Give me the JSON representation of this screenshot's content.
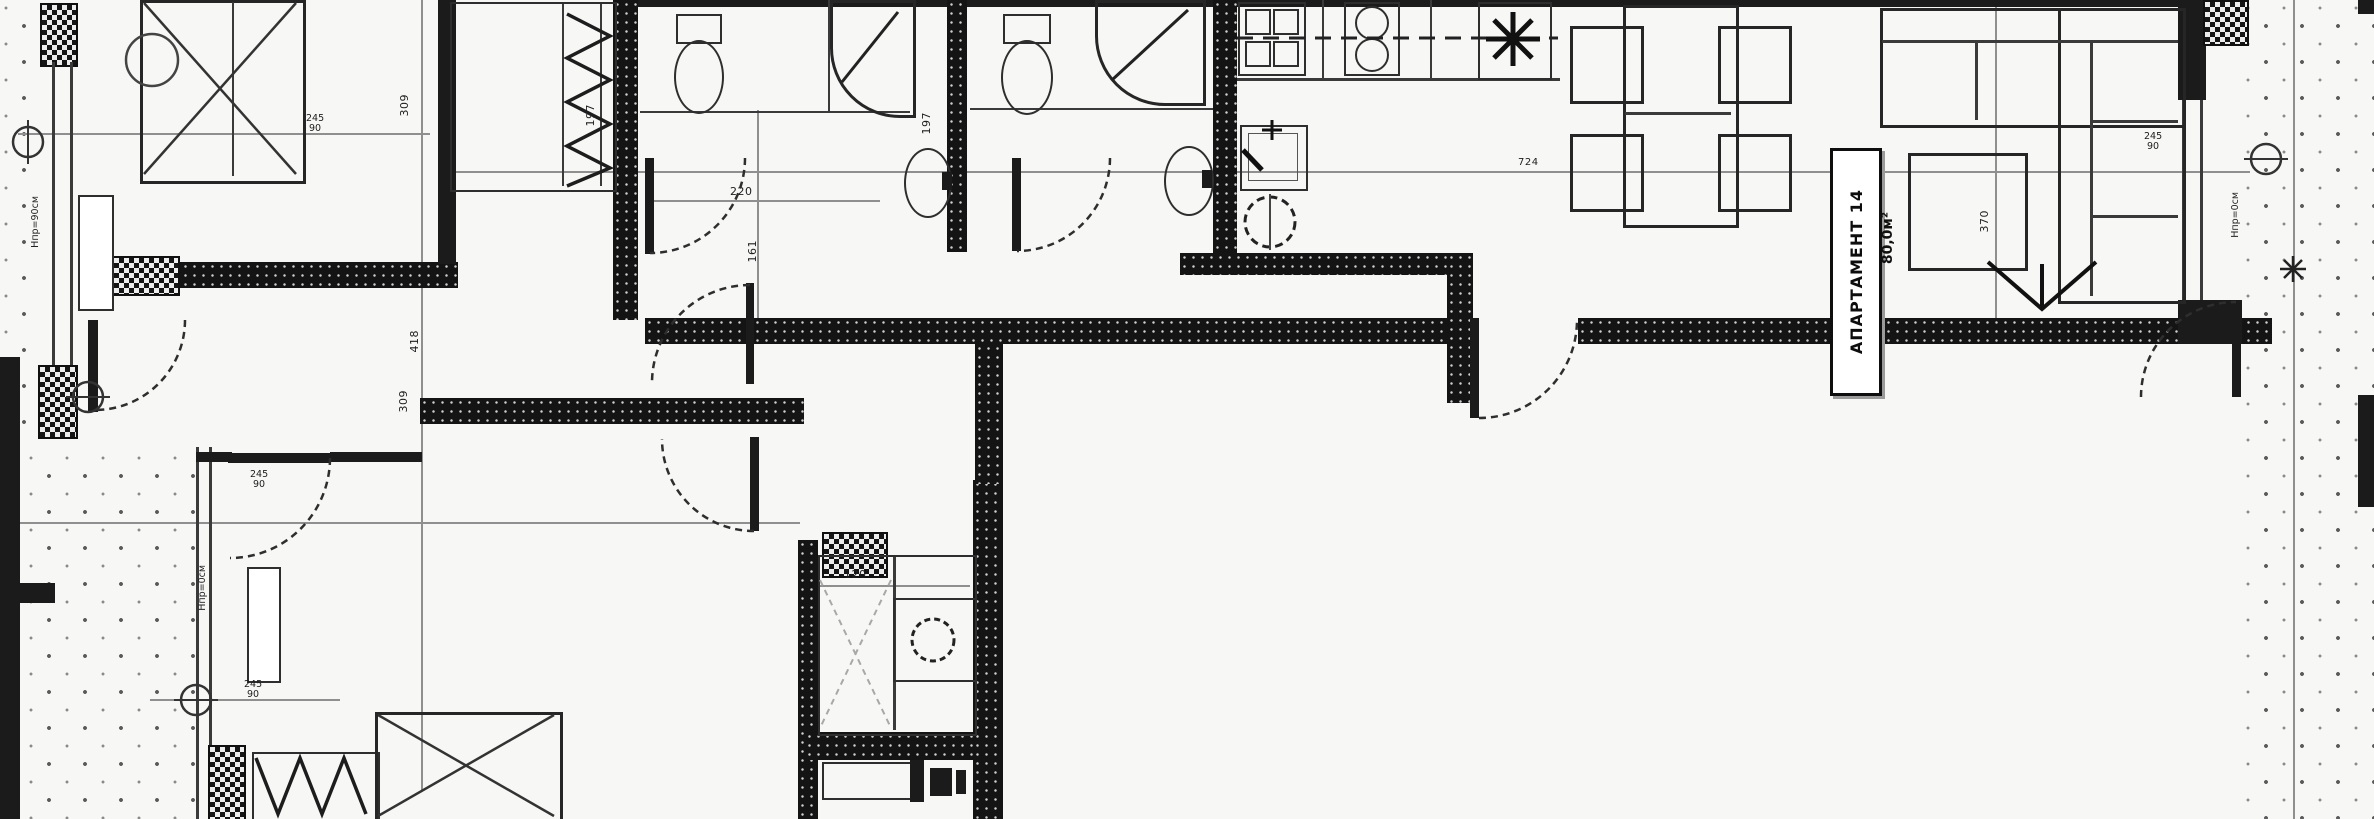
{
  "apartment_label": {
    "title": "АПАРТАМЕНТ 14",
    "area": "80,0м²"
  },
  "dimensions": {
    "chain_left": [
      "309",
      "418",
      "309"
    ],
    "bath_a_depth": "197",
    "bath_b_depth": "197",
    "bath_a_width": "220",
    "corridor": "161",
    "closet_width": "120",
    "living_width": "370",
    "overall_width": "724",
    "openings": [
      {
        "h": "245",
        "w": "90"
      },
      {
        "h": "245",
        "w": "90"
      },
      {
        "h": "245",
        "w": "90"
      },
      {
        "h": "245",
        "w": "90"
      }
    ]
  },
  "annotations": {
    "parapet_left": "Нпр=90см",
    "parapet_bedroom2": "Нпр=0см",
    "parapet_terrace": "Нпр=0см"
  }
}
